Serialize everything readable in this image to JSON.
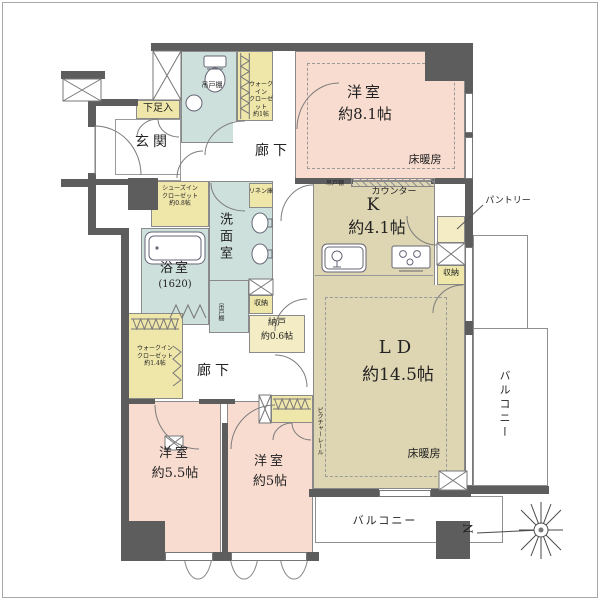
{
  "colors": {
    "wall": "#5d5d5d",
    "room_pink": "#f8dcd0",
    "room_beige": "#ded5b2",
    "room_blue": "#cde0db",
    "storage_yellow": "#efe6aa",
    "line": "#8a8a8a"
  },
  "entrance": {
    "label": "玄関",
    "shoe_cabinet": "下足入",
    "shoes_in_closet": "シューズイン\nクローゼット\n約0.8帖"
  },
  "toilet": {
    "hanging_cupboard": "吊戸棚"
  },
  "corridors": {
    "upper": "廊下",
    "lower": "廊下"
  },
  "western1": {
    "name": "洋室",
    "size": "約8.1帖",
    "floor_heating": "床暖房"
  },
  "kitchen": {
    "name": "K",
    "size": "約4.1帖",
    "counter": "カウンター",
    "hanging_cupboard": "吊戸棚",
    "pantry": "パントリー",
    "storage": "収納"
  },
  "ld": {
    "name": "LD",
    "size": "約14.5帖",
    "floor_heating": "床暖房",
    "picture_rail": "ピクチャーレール"
  },
  "western2": {
    "name": "洋室",
    "size": "約5.5帖"
  },
  "western3": {
    "name": "洋室",
    "size": "約5帖"
  },
  "bathroom": {
    "name": "浴室",
    "size": "(1620)"
  },
  "washroom": {
    "name": "洗面室",
    "hanging_cupboard": "吊戸棚",
    "linen": "リネン庫",
    "storage": "収納"
  },
  "storage": {
    "wic_upper": "ウォークイン\nクローゼット\n約1帖",
    "wic_lower": "ウォークイン\nクローゼット\n約1.4帖",
    "nando_name": "納戸",
    "nando_size": "約0.6帖"
  },
  "balcony": {
    "right": "バルコニー",
    "bottom": "バルコニー"
  },
  "compass": {
    "north": "N"
  }
}
